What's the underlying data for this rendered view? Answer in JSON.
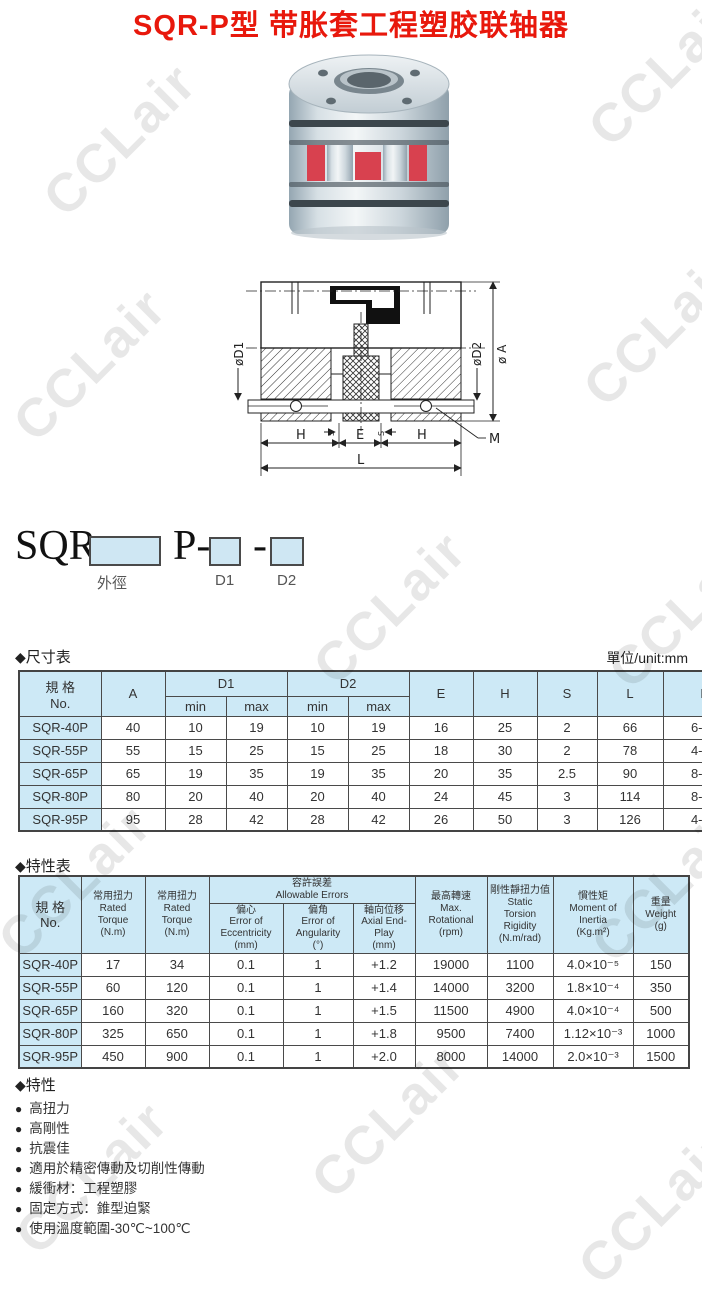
{
  "page": {
    "title": "SQR-P型 带胀套工程塑胶联轴器",
    "title_color": "#e8180c",
    "watermark": "CCLair"
  },
  "icons": {
    "diamond": "◆",
    "bullet": "●"
  },
  "ordering": {
    "prefix": "SQR-",
    "outer_dia_label": "外徑",
    "mid": "P-",
    "d1_label": "D1",
    "dash": "-",
    "d2_label": "D2",
    "box_fill": "#cfe7f3"
  },
  "drawing": {
    "labels": {
      "d1": "øD1",
      "d2": "øD2",
      "a": "ø A",
      "h_left": "H",
      "e": "E",
      "h_right": "H",
      "l": "L",
      "m": "M",
      "s_left": "S",
      "s_right": "S"
    }
  },
  "dimension_table": {
    "section_title": "尺寸表",
    "unit_label": "單位/unit:mm",
    "header": {
      "spec": "規 格\nNo.",
      "a": "A",
      "d1": "D1",
      "d2": "D2",
      "min": "min",
      "max": "max",
      "e": "E",
      "h": "H",
      "s": "S",
      "l": "L",
      "m": "M"
    },
    "rows": [
      {
        "no": "SQR-40P",
        "a": "40",
        "d1min": "10",
        "d1max": "19",
        "d2min": "10",
        "d2max": "19",
        "e": "16",
        "h": "25",
        "s": "2",
        "l": "66",
        "m": "6-M4"
      },
      {
        "no": "SQR-55P",
        "a": "55",
        "d1min": "15",
        "d1max": "25",
        "d2min": "15",
        "d2max": "25",
        "e": "18",
        "h": "30",
        "s": "2",
        "l": "78",
        "m": "4-M5"
      },
      {
        "no": "SQR-65P",
        "a": "65",
        "d1min": "19",
        "d1max": "35",
        "d2min": "19",
        "d2max": "35",
        "e": "20",
        "h": "35",
        "s": "2.5",
        "l": "90",
        "m": "8-M5"
      },
      {
        "no": "SQR-80P",
        "a": "80",
        "d1min": "20",
        "d1max": "40",
        "d2min": "20",
        "d2max": "40",
        "e": "24",
        "h": "45",
        "s": "3",
        "l": "114",
        "m": "8-M6"
      },
      {
        "no": "SQR-95P",
        "a": "95",
        "d1min": "28",
        "d1max": "42",
        "d2min": "28",
        "d2max": "42",
        "e": "26",
        "h": "50",
        "s": "3",
        "l": "126",
        "m": "4-M8"
      }
    ]
  },
  "char_table": {
    "section_title": "特性表",
    "header": {
      "spec": "規 格\nNo.",
      "rated_torque_1": "常用扭力\nRated\nTorque\n(N.m)",
      "rated_torque_2": "常用扭力\nRated\nTorque\n(N.m)",
      "allowable_errors": "容許誤差\nAllowable Errors",
      "eccentricity": "偏心\nError of\nEccentricity\n(mm)",
      "angularity": "偏角\nError of\nAngularity\n(°)",
      "axial": "軸向位移\nAxial End-\nPlay\n(mm)",
      "max_rotational": "最高轉速\nMax.\nRotational\n(rpm)",
      "rigidity": "剛性靜扭力值\nStatic\nTorsion\nRigidity\n(N.m/rad)",
      "inertia": "慣性矩\nMoment of\nInertia\n(Kg.m²)",
      "weight": "重量\nWeight\n(g)"
    },
    "rows": [
      {
        "no": "SQR-40P",
        "rated1": "17",
        "rated2": "34",
        "ecc": "0.1",
        "ang": "1",
        "axial": "+1.2",
        "rpm": "19000",
        "rigidity": "1100",
        "inertia": "4.0×10⁻⁵",
        "weight": "150"
      },
      {
        "no": "SQR-55P",
        "rated1": "60",
        "rated2": "120",
        "ecc": "0.1",
        "ang": "1",
        "axial": "+1.4",
        "rpm": "14000",
        "rigidity": "3200",
        "inertia": "1.8×10⁻⁴",
        "weight": "350"
      },
      {
        "no": "SQR-65P",
        "rated1": "160",
        "rated2": "320",
        "ecc": "0.1",
        "ang": "1",
        "axial": "+1.5",
        "rpm": "11500",
        "rigidity": "4900",
        "inertia": "4.0×10⁻⁴",
        "weight": "500"
      },
      {
        "no": "SQR-80P",
        "rated1": "325",
        "rated2": "650",
        "ecc": "0.1",
        "ang": "1",
        "axial": "+1.8",
        "rpm": "9500",
        "rigidity": "7400",
        "inertia": "1.12×10⁻³",
        "weight": "1000"
      },
      {
        "no": "SQR-95P",
        "rated1": "450",
        "rated2": "900",
        "ecc": "0.1",
        "ang": "1",
        "axial": "+2.0",
        "rpm": "8000",
        "rigidity": "14000",
        "inertia": "2.0×10⁻³",
        "weight": "1500"
      }
    ]
  },
  "features": {
    "section_title": "特性",
    "items": [
      "高扭力",
      "高剛性",
      "抗震佳",
      "適用於精密傳動及切削性傳動",
      "緩衝材：工程塑膠",
      "固定方式：錐型迫緊",
      "使用溫度範圍-30℃~100℃"
    ]
  }
}
